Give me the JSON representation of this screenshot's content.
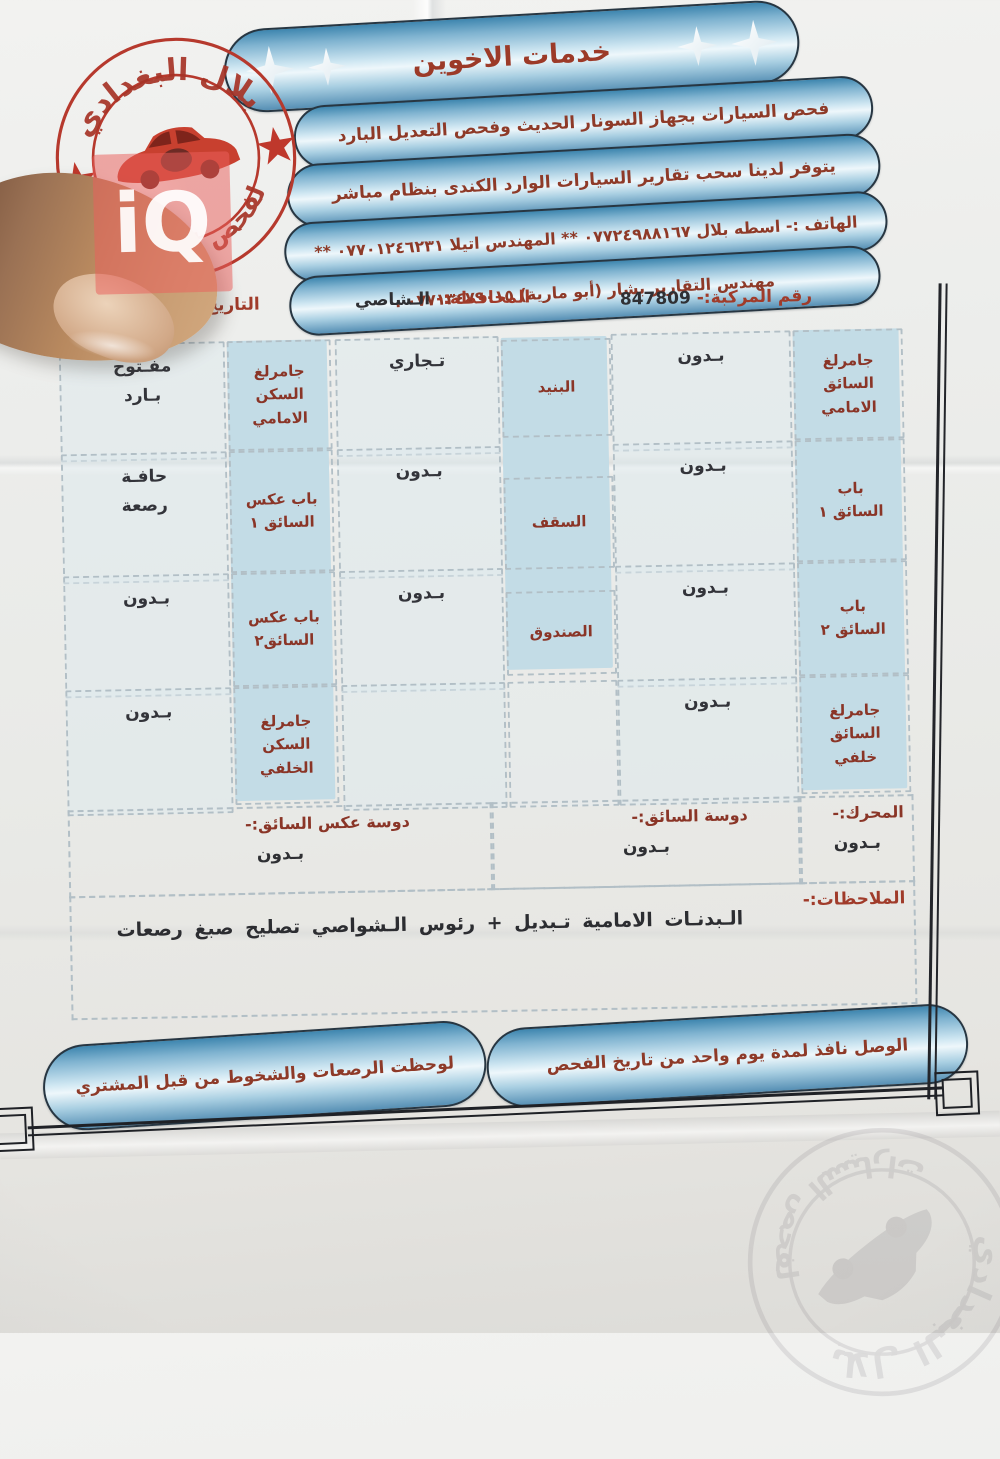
{
  "watermark": {
    "text": "iQ"
  },
  "stamp": {
    "top_text": "بلال البغدادي",
    "bottom_text": "لفحص السيارات"
  },
  "header": {
    "title": "خدمات الاخوين",
    "line2": "فحص السيارات بجهاز السونار الحديث وفحص التعديل البارد",
    "line3": "يتوفر لدينا سحب تقارير السيارات الوارد الكندى بنظام مباشر",
    "line4": "الهاتف :- اسطه بلال ٠٧٧٢٤٩٨٨١٦٧ ** المهندس اتيلا ٠٧٧٠١٢٤٦٢٣١ **",
    "line5": "مهندس التقارير بشار (أبو مارية) ٠٧٧١٣٤٧٩٠١٥ ."
  },
  "info": {
    "plate_label": "رقم المركبة:-",
    "plate_value": "847809",
    "gov_label": "المحافظة:-",
    "gov_value": "الـشاصي",
    "date_label": "التاريخ:-",
    "date_value": ""
  },
  "grid": {
    "rows": [
      {
        "right_label": "جامرلغ\nالسائق\nالامامي",
        "right_value": "بـدون",
        "mid_label": "البنيد",
        "mid_value": "تـجاري",
        "left_label": "جامرلغ\nالسكن\nالامامي",
        "left_value": "مفـتوح\nبـارد"
      },
      {
        "right_label": "باب\nالسائق ١",
        "right_value": "بـدون",
        "mid_label": "السقف",
        "mid_value": "بـدون",
        "left_label": "باب عكس\nالسائق ١",
        "left_value": "حافـة\nرصعة"
      },
      {
        "right_label": "باب\nالسائق ٢",
        "right_value": "بـدون",
        "mid_label": "الصندوق",
        "mid_value": "بـدون",
        "left_label": "باب عكس\nالسائق٢",
        "left_value": "بـدون"
      },
      {
        "right_label": "جامرلغ\nالسائق\nخلفي",
        "right_value": "بـدون",
        "mid_label": "",
        "mid_value": "",
        "left_label": "جامرلغ\nالسكن\nالخلفي",
        "left_value": "بـدون"
      }
    ]
  },
  "pedals": {
    "engine_label": "المحرك:-",
    "engine_value": "بـدون",
    "driver_label": "دوسة السائق:-",
    "driver_value": "بـدون",
    "passenger_label": "دوسة عكس السائق:-",
    "passenger_value": "بـدون"
  },
  "notes": {
    "label": "الملاحظات:-",
    "text": "الـبدنـات الامامية تـبديل + رئوس الـشواصي تصليح صبغ رصعات"
  },
  "footer": {
    "right_pill": "الوصل نافذ لمدة يوم واحد من تاريخ الفحص",
    "left_pill": "لوحظت الرصعات والشخوط من قبل المشتري"
  },
  "colors": {
    "pill_blue": "#5d9cbe",
    "label_red": "#8a3527",
    "stamp_red": "#b6392d",
    "cell_blue": "#c3dce6",
    "watermark_pink": "#ea605c"
  }
}
